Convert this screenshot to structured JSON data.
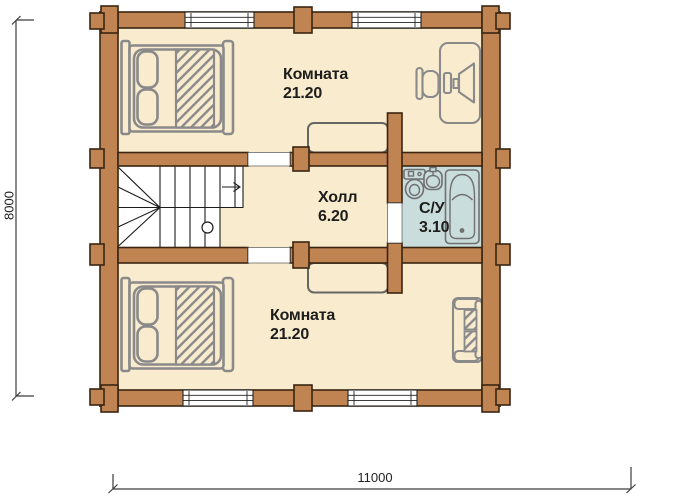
{
  "rooms": [
    {
      "name": "Комната",
      "area": "21.20"
    },
    {
      "name": "Холл",
      "area": "6.20"
    },
    {
      "name": "С/У",
      "area": "3.10"
    },
    {
      "name": "Комната",
      "area": "21.20"
    }
  ],
  "dimensions": {
    "width_mm": "11000",
    "height_mm": "8000"
  },
  "icons": {
    "bed": "double-bed-icon",
    "desk": "computer-desk-icon",
    "chair": "office-chair-icon",
    "sofa": "sofa-icon",
    "wardrobe": "wardrobe-icon",
    "toilet": "toilet-icon",
    "sink": "sink-icon",
    "bathtub": "bathtub-icon",
    "stairs": "staircase-icon"
  },
  "colors": {
    "wall": "#c08352",
    "wall_outline": "#3a2512",
    "floor": "#f9ebce",
    "bathroom_floor": "#c9dddc",
    "furniture": "#8a8a8a",
    "stair_line": "#1c1c1c",
    "dimension_line": "#3c3c3c",
    "text": "#1d1d1b"
  }
}
